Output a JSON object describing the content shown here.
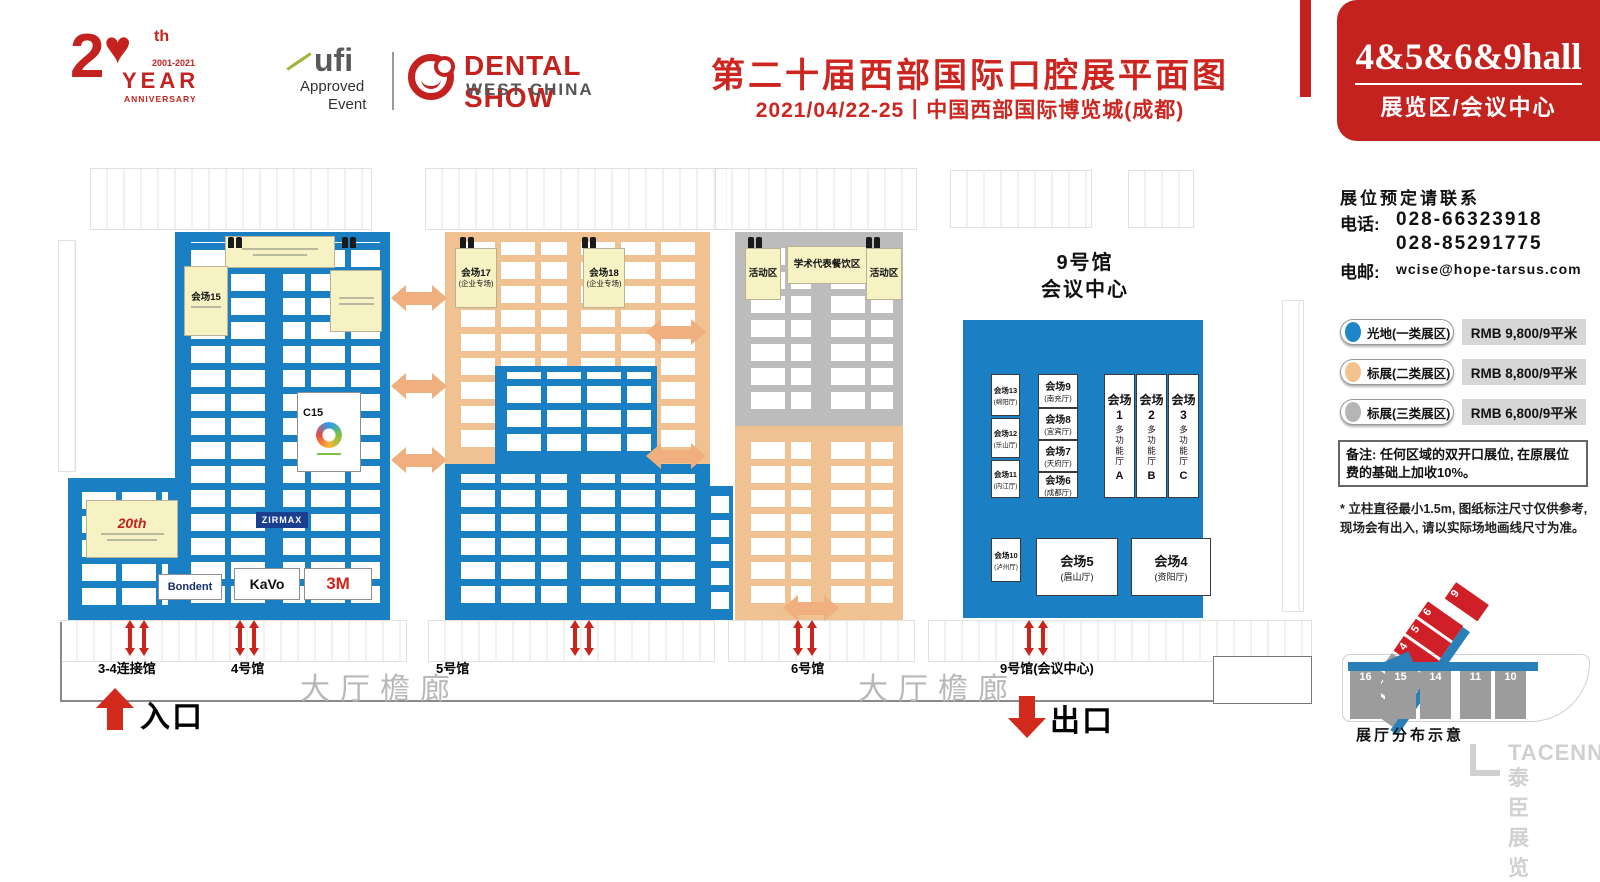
{
  "header": {
    "anniversary": {
      "number": "2",
      "suffix": "th",
      "years": "2001-2021",
      "year": "YEAR",
      "anniversary": "ANNIVERSARY",
      "heart": "♥"
    },
    "ufi": {
      "name": "ufi",
      "approved": "Approved",
      "event": "Event"
    },
    "brand": {
      "title": "DENTAL SHOW",
      "subtitle": "WEST CHINA"
    },
    "title": "第二十届西部国际口腔展平面图",
    "subtitle": "2021/04/22-25丨中国西部国际博览城(成都)",
    "badge": {
      "halls": "4&5&6&9hall",
      "label": "展览区/会议中心"
    }
  },
  "contact": {
    "heading": "展位预定请联系",
    "phone_label": "电话:",
    "phone1": "028-66323918",
    "phone2": "028-85291775",
    "email_label": "电邮:",
    "email": "wcise@hope-tarsus.com"
  },
  "legend": {
    "items": [
      {
        "label": "光地(一类展区)",
        "price": "RMB 9,800/9平米",
        "color": "#1c86c8"
      },
      {
        "label": "标展(二类展区)",
        "price": "RMB 8,800/9平米",
        "color": "#f2c38f"
      },
      {
        "label": "标展(三类展区)",
        "price": "RMB 6,800/9平米",
        "color": "#b5b5b5"
      }
    ],
    "note": "备注: 任何区域的双开口展位, 在原展位费的基础上加收10%。"
  },
  "notes": {
    "footnote1": "* 立柱直径最小1.5m, 图纸标注尺寸仅供参考,",
    "footnote2": "现场会有出入, 请以实际场地画线尺寸为准。"
  },
  "minimap": {
    "caption": "展厅分布示意",
    "diag": [
      "1",
      "2",
      "3",
      "4",
      "5",
      "6"
    ],
    "nine": "9",
    "bottom": [
      "16",
      "15",
      "14",
      "11",
      "10"
    ]
  },
  "watermark": {
    "latin": "TACENN",
    "cjk": "泰臣展览"
  },
  "floor": {
    "labels": {
      "connector": "3-4连接馆",
      "h4": "4号馆",
      "h5": "5号馆",
      "h6": "6号馆",
      "h9": "9号馆(会议中心)",
      "corridor_left": "大厅檐廊",
      "corridor_right": "大厅檐廊",
      "entrance": "入口",
      "exit": "出口"
    },
    "hall4": {
      "room": "会场15",
      "c15": "C15",
      "anniv": "20th",
      "brands": {
        "bondent": "Bondent",
        "kavo": "KaVo",
        "m3": "3M",
        "zirmax": "ZIRMAX"
      }
    },
    "hall5": {
      "room17": "会场17",
      "room17_sub": "(企业专场)",
      "room18": "会场18",
      "room18_sub": "(企业专场)"
    },
    "hall6": {
      "left": "活动区",
      "center": "学术代表餐饮区",
      "right": "活动区"
    },
    "hall9": {
      "t1": "9号馆",
      "t2": "会议中心",
      "left": [
        {
          "name": "会场13",
          "sub": "(绵阳厅)"
        },
        {
          "name": "会场12",
          "sub": "(乐山厅)"
        },
        {
          "name": "会场11",
          "sub": "(内江厅)"
        }
      ],
      "mid": [
        {
          "name": "会场9",
          "sub": "(南充厅)"
        },
        {
          "name": "会场8",
          "sub": "(宜宾厅)"
        },
        {
          "name": "会场7",
          "sub": "(天府厅)"
        },
        {
          "name": "会场6",
          "sub": "(成都厅)"
        }
      ],
      "big": [
        {
          "name": "会场1",
          "sub": "多功能厅",
          "letter": "A"
        },
        {
          "name": "会场2",
          "sub": "多功能厅",
          "letter": "B"
        },
        {
          "name": "会场3",
          "sub": "多功能厅",
          "letter": "C"
        }
      ],
      "bottom": [
        {
          "name": "会场10",
          "sub": "(泸州厅)"
        },
        {
          "name": "会场5",
          "sub": "(眉山厅)"
        },
        {
          "name": "会场4",
          "sub": "(资阳厅)"
        }
      ]
    }
  }
}
